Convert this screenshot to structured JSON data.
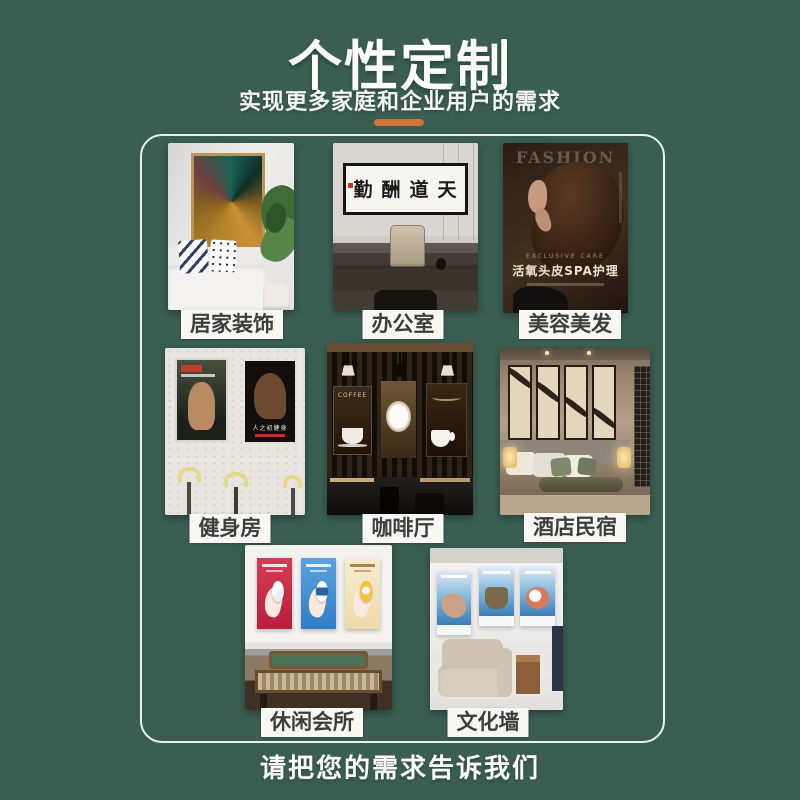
{
  "header": {
    "title": "个性定制",
    "subtitle": "实现更多家庭和企业用户的需求"
  },
  "footer": {
    "text": "请把您的需求告诉我们"
  },
  "colors": {
    "background": "#3a5f52",
    "divider_orange": "#d0753c",
    "panel_border": "#e6f5ec",
    "label_background": "#f8f7f3",
    "label_text": "#3c3d3d"
  },
  "scenes": [
    {
      "id": "home-decor",
      "label": "居家装饰"
    },
    {
      "id": "office",
      "label": "办公室",
      "artwork_text": "天道酬勤"
    },
    {
      "id": "beauty-salon",
      "label": "美容美发",
      "poster_title": "FASHION",
      "poster_tagline": "EXCLUSIVE CARE",
      "poster_subtitle": "活氧头皮SPA护理"
    },
    {
      "id": "gym",
      "label": "健身房",
      "poster_text": "人之初健身"
    },
    {
      "id": "coffee-shop",
      "label": "咖啡厅",
      "poster_text": "COFFEE"
    },
    {
      "id": "hotel-bnb",
      "label": "酒店民宿"
    },
    {
      "id": "leisure-club",
      "label": "休闲会所"
    },
    {
      "id": "culture-wall",
      "label": "文化墙"
    }
  ]
}
